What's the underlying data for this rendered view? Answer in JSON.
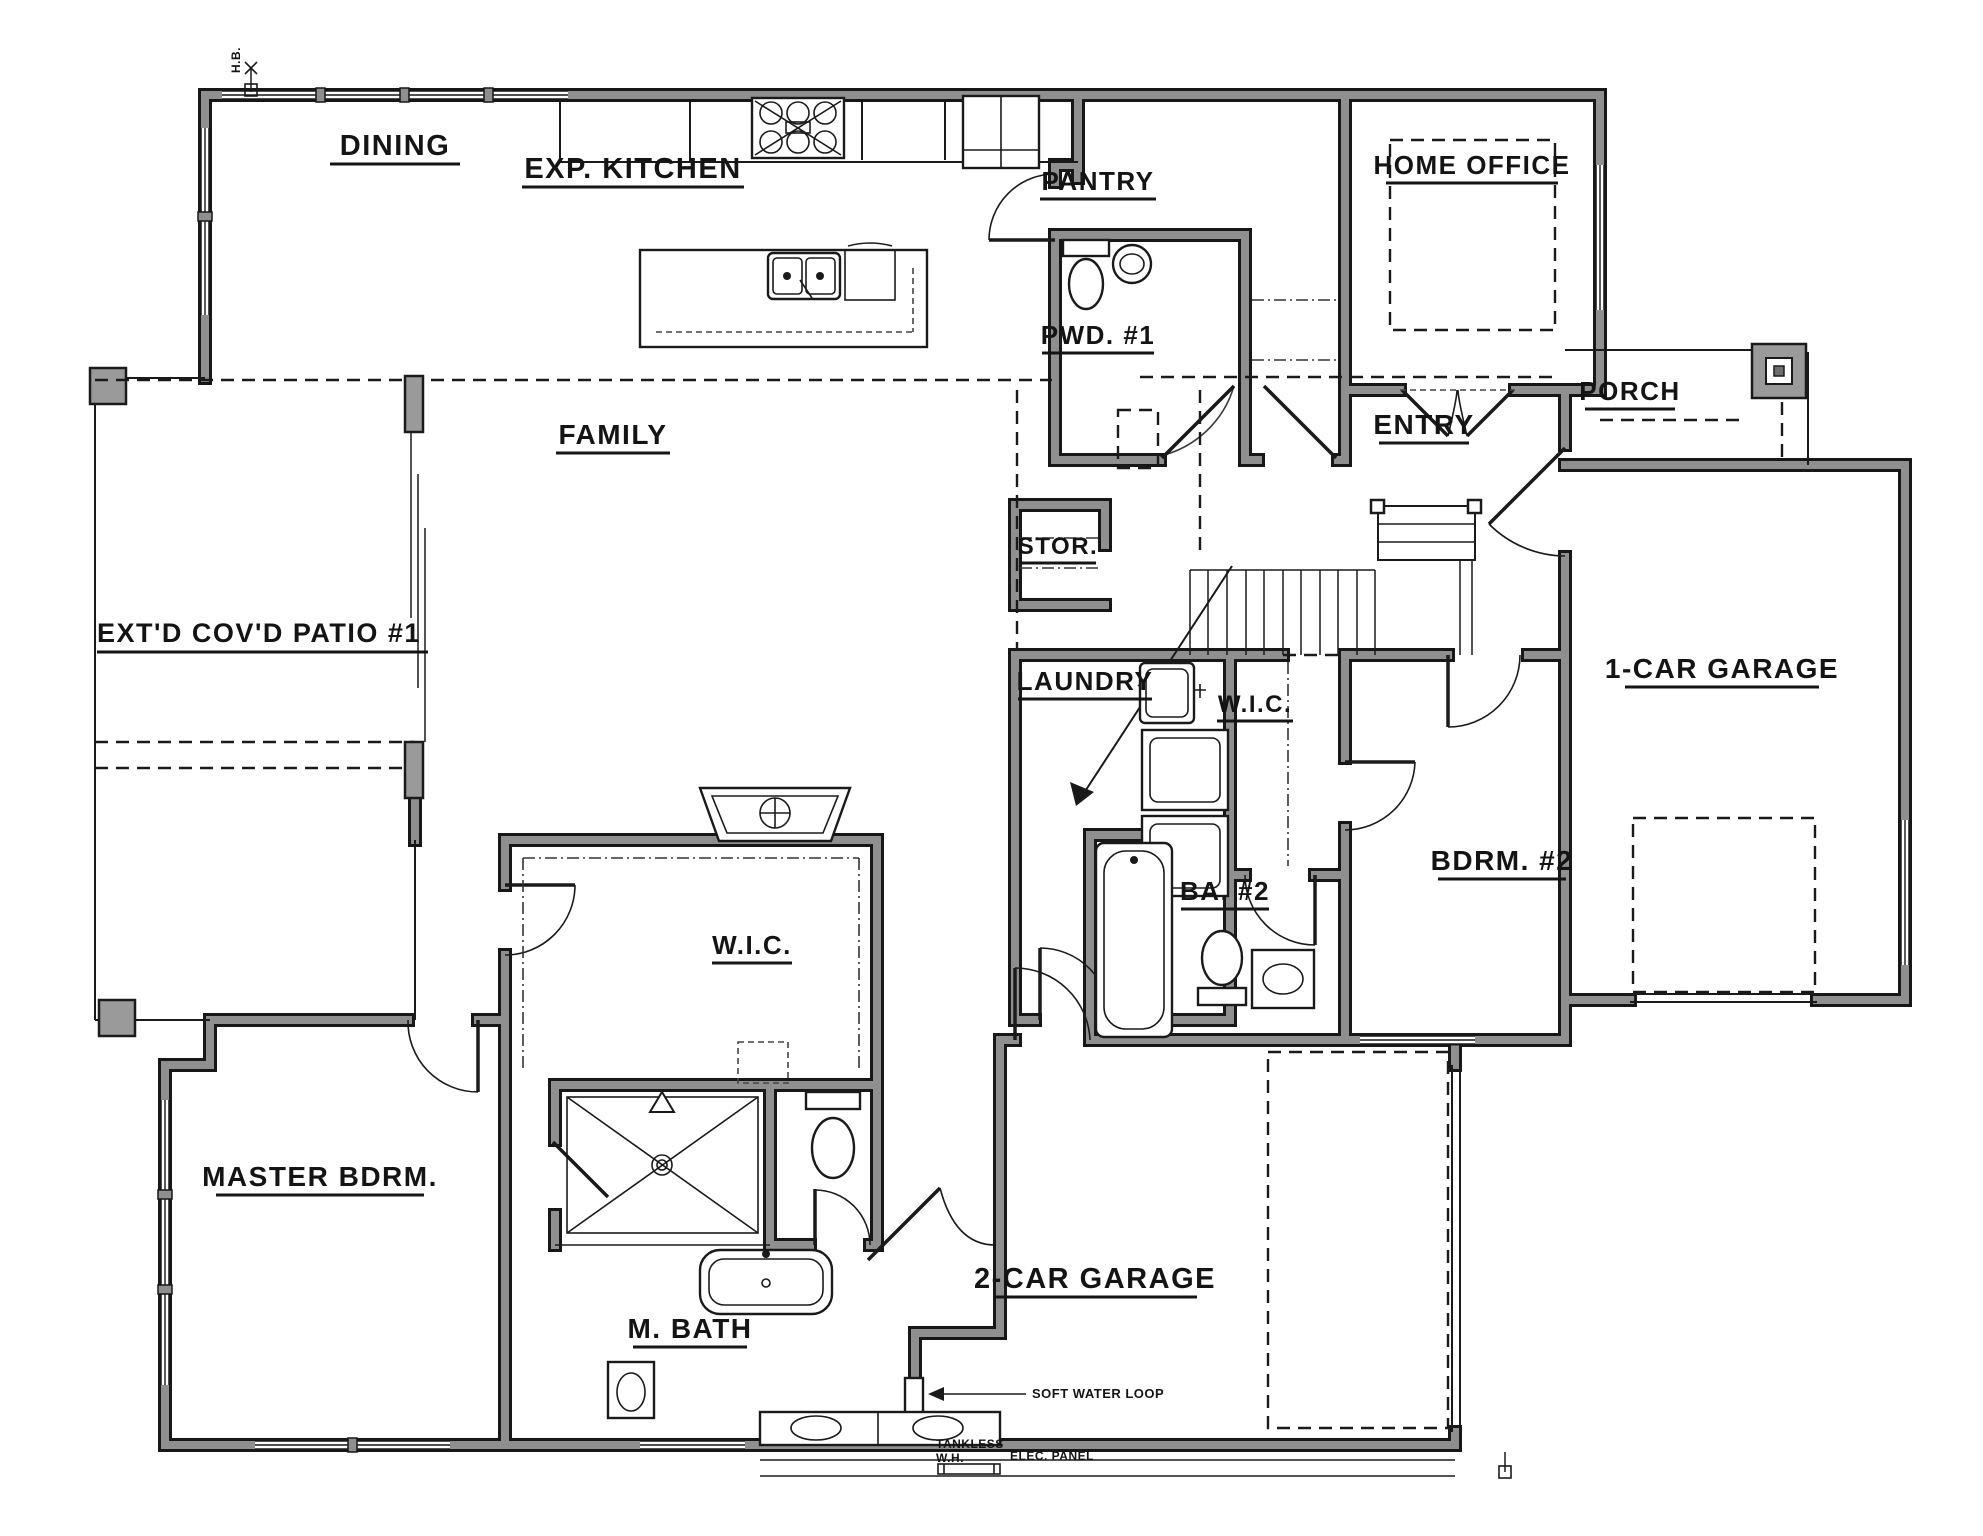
{
  "plan": {
    "type": "residential-floor-plan",
    "view": "first-floor"
  },
  "colors": {
    "paper": "#ffffff",
    "line": "#171717",
    "wall_fill": "#8f8f8f",
    "column_fill": "#9a9a9a"
  },
  "labels": {
    "dining": "DINING",
    "kitchen": "EXP. KITCHEN",
    "pantry": "PANTRY",
    "pwd1": "PWD. #1",
    "home_office": "HOME OFFICE",
    "porch": "PORCH",
    "entry": "ENTRY",
    "family": "FAMILY",
    "patio": "EXT'D COV'D PATIO #1",
    "stor": "STOR.",
    "laundry": "LAUNDRY",
    "wic_hall": "W.I.C.",
    "one_car_garage": "1-CAR GARAGE",
    "bdrm2": "BDRM. #2",
    "ba2": "BA. #2",
    "wic_master": "W.I.C.",
    "master_bdrm": "MASTER BDRM.",
    "m_bath": "M. BATH",
    "two_car_garage": "2-CAR GARAGE"
  },
  "annotations": {
    "soft_water_loop": "SOFT WATER LOOP",
    "tankless_line1": "TANKLESS",
    "tankless_line2": "W.H.",
    "elec_panel": "ELEC. PANEL",
    "hose_bib": "H.B."
  },
  "icons": {
    "stair_direction_arrow": "stairs-up-arrow",
    "shower_head": "shower-head-triangle",
    "cooktop": "six-burner-cooktop",
    "double_sink_island": "kitchen-island-double-sink"
  }
}
